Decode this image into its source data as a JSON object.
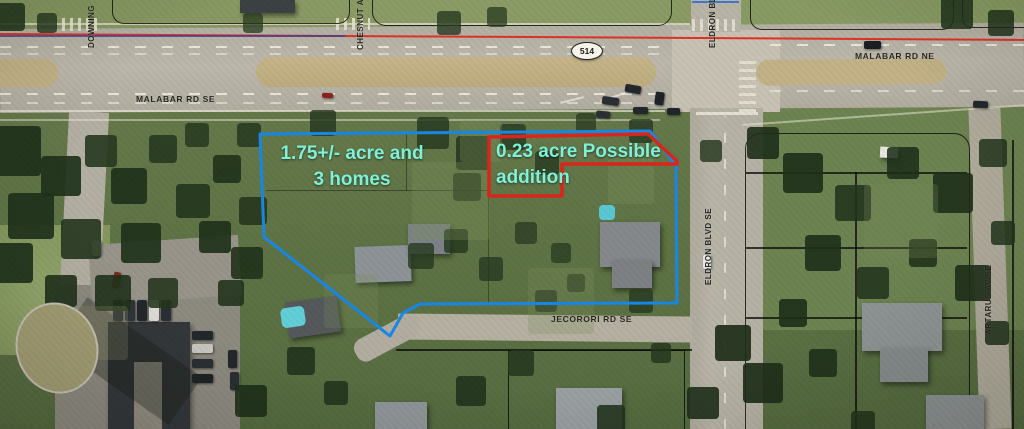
{
  "annotations": {
    "parcel_main": {
      "label_line1": "1.75+/- acre and",
      "label_line2": "3 homes",
      "outline_color": "#1787e6",
      "text_color": "#7df2d8"
    },
    "parcel_addition": {
      "label_line1": "0.23 acre Possible",
      "label_line2": "addition",
      "outline_color": "#d8261c",
      "text_color": "#7df2d8"
    },
    "boundary_line_color": "#e03226",
    "boundary_line2_color": "#45418f"
  },
  "map_labels": {
    "malabar_sw": "MALABAR RD SE",
    "malabar_ne": "MALABAR RD NE",
    "route_shield": "514",
    "eldron_north": "ELDRON BLVD",
    "eldron_south": "ELDRON BLVD SE",
    "downing": "DOWNING",
    "chesnut": "CHESNUT AVE",
    "artarus": "ARTARUS AV SE",
    "jecorori": "JECORORI RD SE"
  }
}
